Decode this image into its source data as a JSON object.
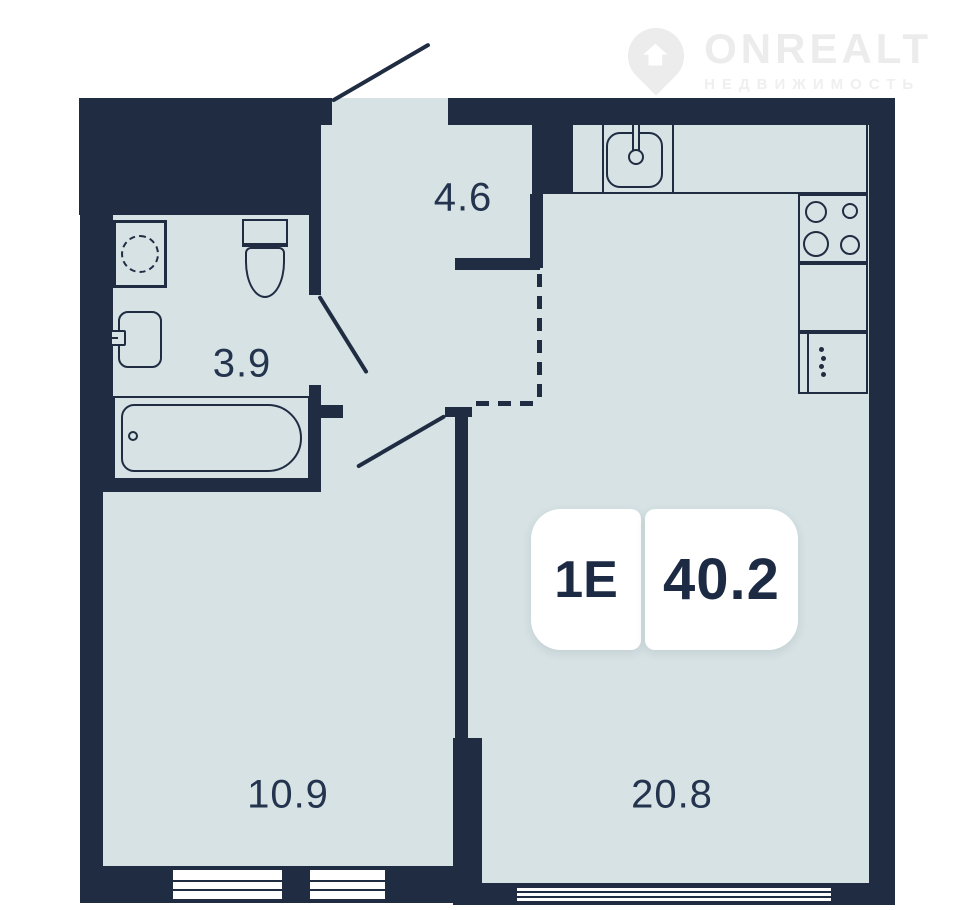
{
  "logo": {
    "brand": "ONREALT",
    "subtitle": "НЕДВИЖИМОСТЬ"
  },
  "plan": {
    "badge": {
      "type": "1Е",
      "area": "40.2"
    },
    "rooms": [
      {
        "id": "hallway",
        "area_label": "4.6"
      },
      {
        "id": "bathroom",
        "area_label": "3.9"
      },
      {
        "id": "bedroom",
        "area_label": "10.9"
      },
      {
        "id": "living-kitchen",
        "area_label": "20.8"
      }
    ],
    "fixtures": [
      "washing-machine",
      "toilet",
      "bathroom-sink",
      "bathtub",
      "kitchen-counter",
      "kitchen-sink",
      "stove",
      "kitchen-cabinet",
      "fridge"
    ],
    "colors": {
      "wall": "#1f2c42",
      "floor": "#d6e2e4",
      "background": "#ffffff",
      "badge_background": "#ffffff",
      "logo_gray": "#ececec"
    }
  }
}
